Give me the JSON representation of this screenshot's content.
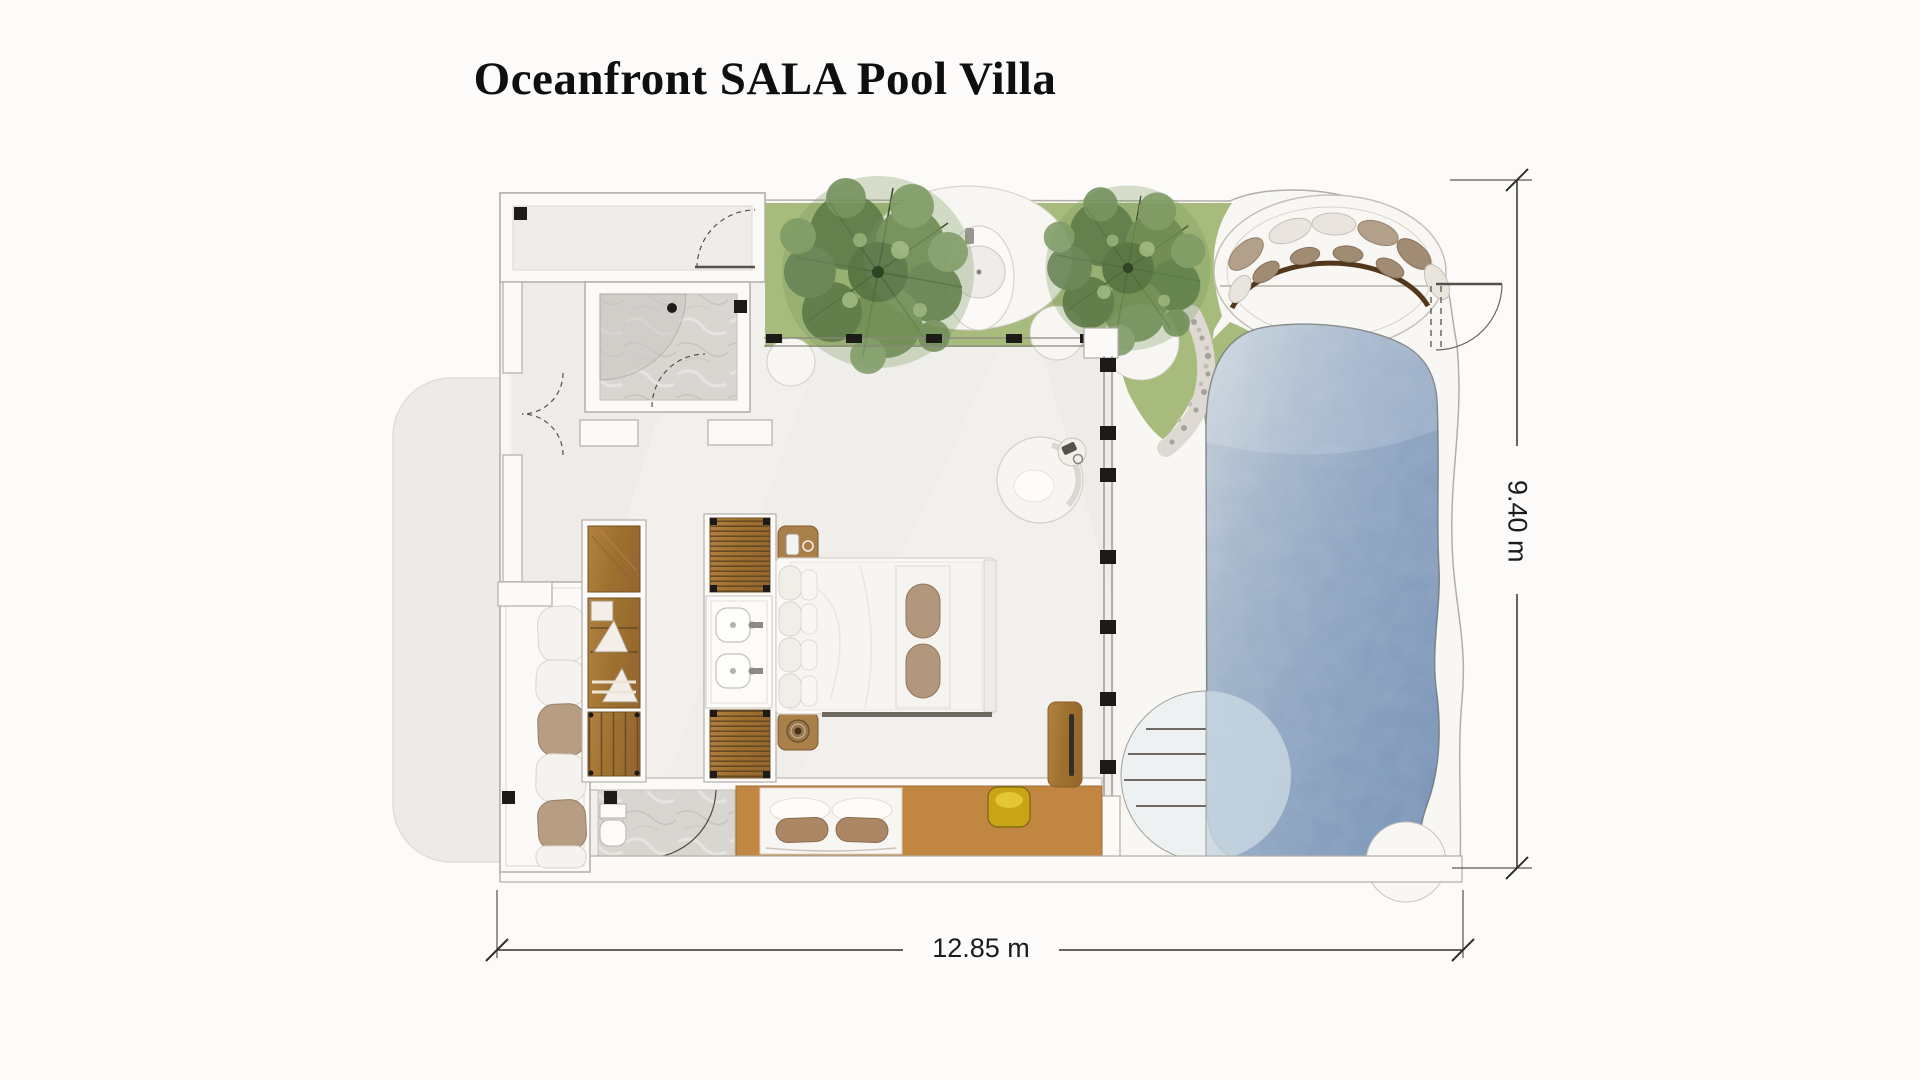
{
  "title": "Oceanfront SALA Pool Villa",
  "dimensions": {
    "height": "9.40 m",
    "width": "12.85 m"
  },
  "colors": {
    "background": "#fcfbfa",
    "plot": "#f8f7f4",
    "wall_fill": "#fbfaf8",
    "wall_outline": "#b3aea7",
    "floor": "#f2f0ed",
    "terrace": "#edebe8",
    "grass": "#a7bb7d",
    "tree_dark": "#5d7a47",
    "tree_light": "#7f9c66",
    "pool_light": "#c9d2db",
    "pool_deep": "#7b95b8",
    "wood": "#a97f42",
    "deck": "#c08642",
    "cushion_tan": "#b2977c",
    "stool_yellow": "#c8a416",
    "marble": "#d9d6d2",
    "dimension_text": "#1c1c1c"
  }
}
